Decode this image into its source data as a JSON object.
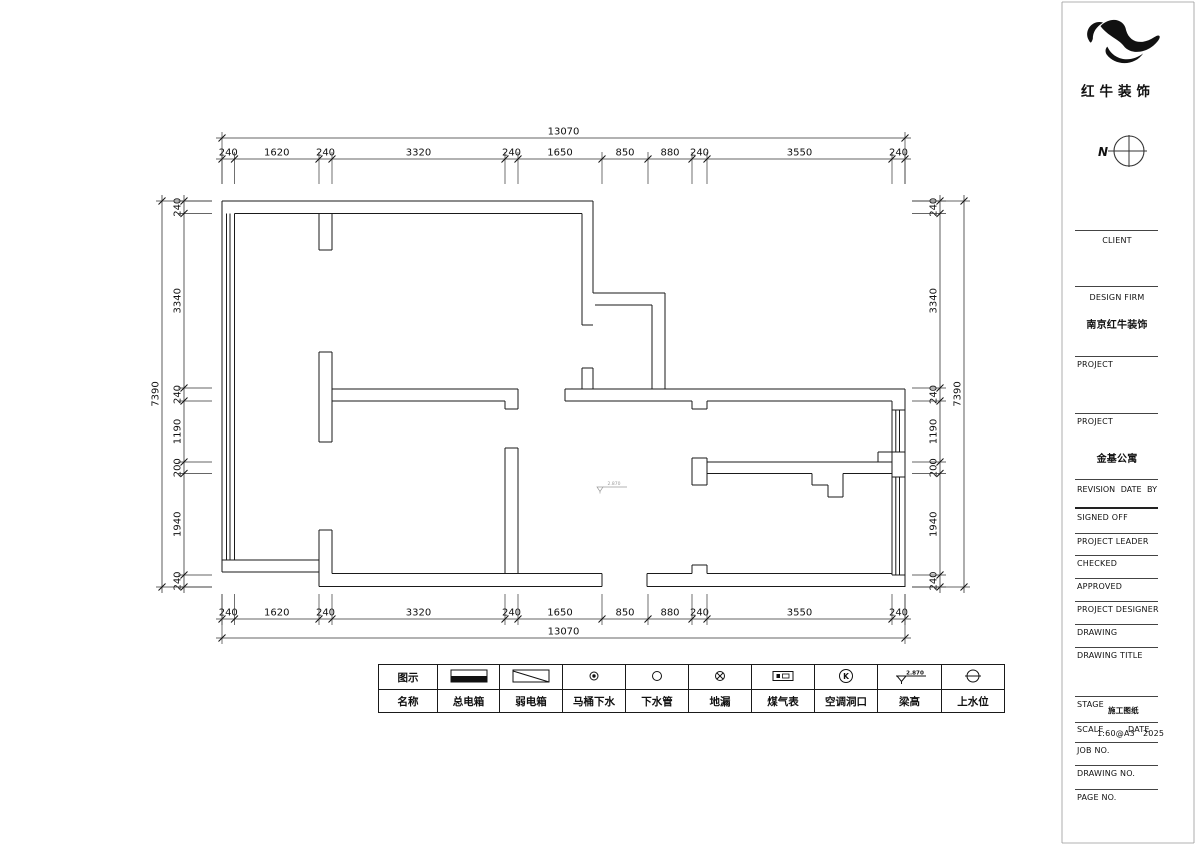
{
  "brand": {
    "logo_text": "红牛装饰"
  },
  "compass": {
    "north_label": "N"
  },
  "dimensions": {
    "top_total": "13070",
    "top_segments": [
      "240",
      "1620",
      "240",
      "3320",
      "240",
      "1650",
      "850",
      "880",
      "240",
      "3550",
      "240"
    ],
    "bottom_total": "13070",
    "bottom_segments": [
      "240",
      "1620",
      "240",
      "3320",
      "240",
      "1650",
      "850",
      "880",
      "240",
      "3550",
      "240"
    ],
    "left_total": "7390",
    "left_segments": [
      "240",
      "3340",
      "240",
      "1190",
      "200",
      "1940",
      "240"
    ],
    "right_total": "7390",
    "right_segments": [
      "240",
      "3340",
      "240",
      "1190",
      "200",
      "1940",
      "240"
    ]
  },
  "plan": {
    "beam_marker_value": "2.870"
  },
  "legend": {
    "symbol_row_label": "图示",
    "name_row_label": "名称",
    "items": [
      {
        "name": "总电箱",
        "symbol": "main-electric-box"
      },
      {
        "name": "弱电箱",
        "symbol": "weak-electric-box"
      },
      {
        "name": "马桶下水",
        "symbol": "toilet-drain"
      },
      {
        "name": "下水管",
        "symbol": "drain-pipe"
      },
      {
        "name": "地漏",
        "symbol": "floor-drain"
      },
      {
        "name": "煤气表",
        "symbol": "gas-meter"
      },
      {
        "name": "空调洞口",
        "symbol": "ac-opening"
      },
      {
        "name": "梁高",
        "symbol": "beam-height",
        "symbol_value": "2.870"
      },
      {
        "name": "上水位",
        "symbol": "water-supply-level"
      }
    ]
  },
  "title_block": {
    "client_label": "CLIENT",
    "design_firm_label": "DESIGN FIRM",
    "design_firm_value": "南京红牛装饰",
    "project_label_1": "PROJECT",
    "project_label_2": "PROJECT",
    "project_value": "金基公寓",
    "revision_label": "REVISION",
    "date_label": "DATE",
    "by_label": "BY",
    "signed_off_label": "SIGNED OFF",
    "project_leader_label": "PROJECT LEADER",
    "checked_label": "CHECKED",
    "approved_label": "APPROVED",
    "project_designer_label": "PROJECT DESIGNER",
    "drawing_label": "DRAWING",
    "drawing_title_label": "DRAWING TITLE",
    "stage_label": "STAGE",
    "stage_value": "施工图纸",
    "scale_label": "SCALE",
    "scale_value": "1:60@A3",
    "date_field_label": "DATE",
    "date_value": "2025",
    "job_no_label": "JOB NO.",
    "drawing_no_label": "DRAWING NO.",
    "page_no_label": "PAGE NO."
  }
}
